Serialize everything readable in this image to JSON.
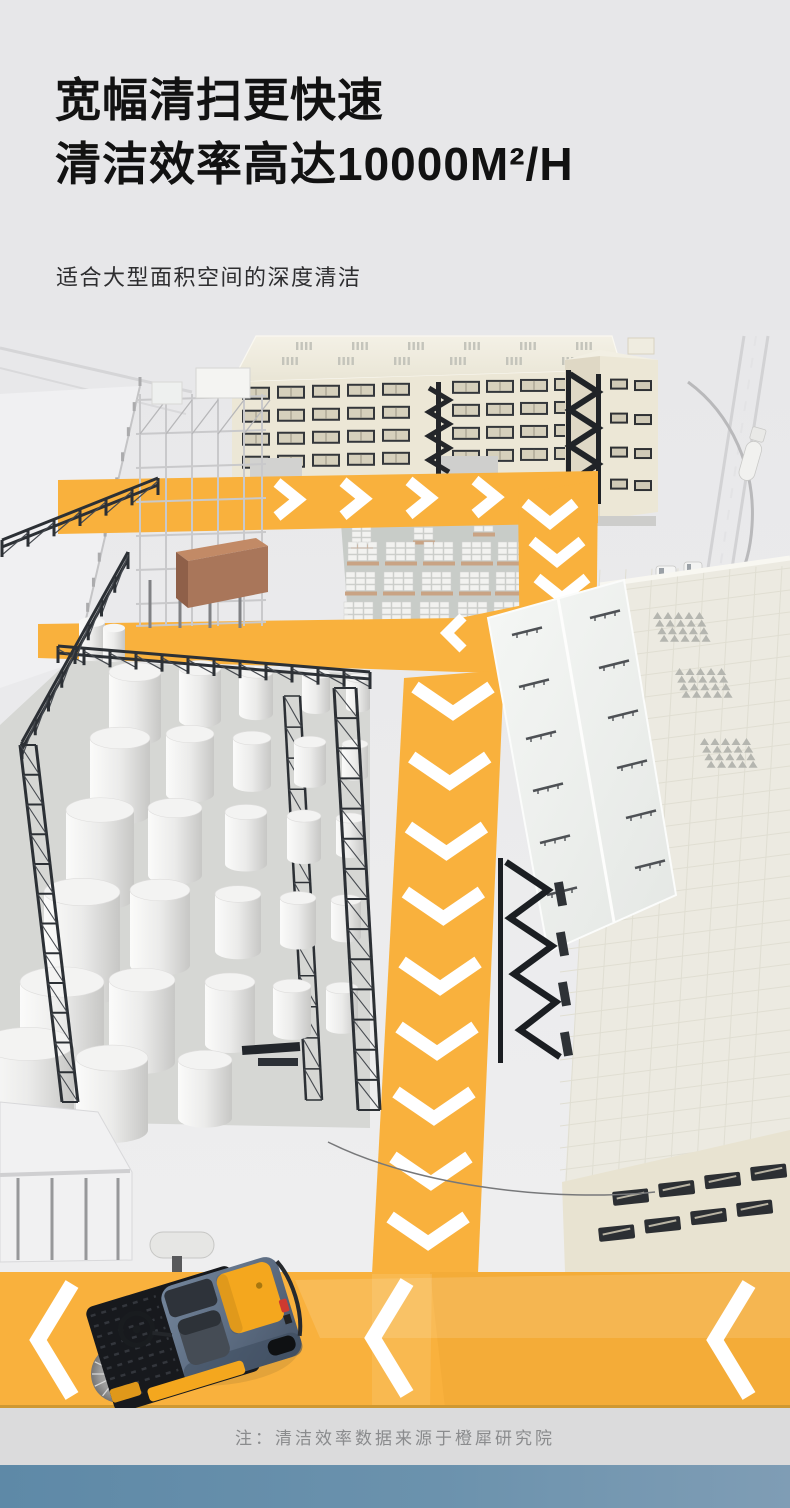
{
  "header": {
    "title_line1": "宽幅清扫更快速",
    "title_line2": "清洁效率高达10000M²/H",
    "subtitle": "适合大型面积空间的深度清洁"
  },
  "footer": {
    "note": "注：清洁效率数据来源于橙犀研究院"
  },
  "colors": {
    "background": "#e7e7e9",
    "headline_text": "#121212",
    "subtitle_text": "#2e2e30",
    "path_yellow": "#f9b13d",
    "chevron_white": "#ffffff",
    "building_cream": "#ece7d6",
    "roof_cream": "#f2efe3",
    "steel_dark": "#2c3035",
    "tank_white": "#f3f3f2",
    "warehouse_roof": "#eceae1",
    "pallet_pad": "#c8ccc8",
    "machine_body": "#5a6b7e",
    "machine_accent": "#f4a71e",
    "footer_bg": "#dbdbdc",
    "footer_text": "#8a8b8d",
    "bottom_bar_left": "#5e89a7",
    "bottom_bar_right": "#7f9db5"
  }
}
